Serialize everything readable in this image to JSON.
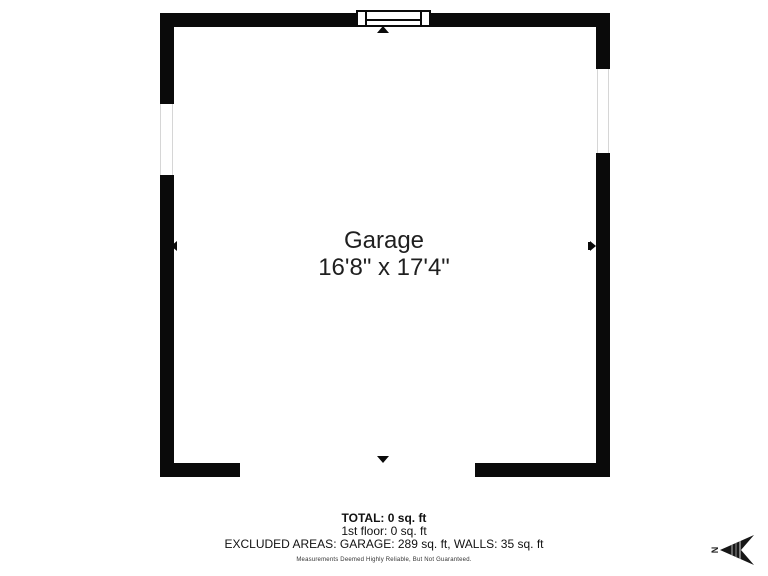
{
  "colors": {
    "wall": "#0a0a0a",
    "background": "#ffffff",
    "text": "#1f1f1f"
  },
  "floor_plan": {
    "room": {
      "name": "Garage",
      "dimensions": "16'8\" x 17'4\""
    }
  },
  "footer": {
    "total": "TOTAL: 0 sq. ft",
    "first_floor": "1st floor: 0 sq. ft",
    "excluded_areas": "EXCLUDED AREAS: GARAGE: 289 sq. ft, WALLS: 35 sq. ft",
    "disclaimer": "Measurements Deemed Highly Reliable, But Not Guaranteed."
  },
  "compass": {
    "north_label": "N"
  }
}
